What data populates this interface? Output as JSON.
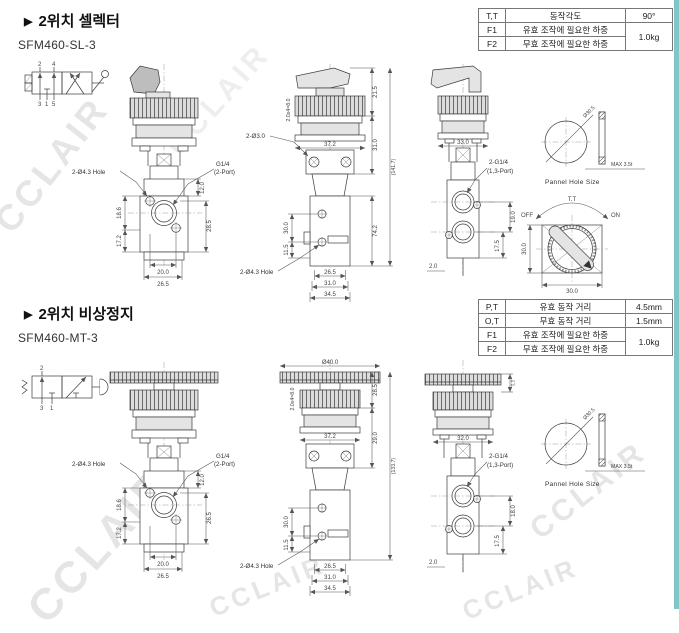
{
  "watermark": "CCLAIR",
  "selector": {
    "marker": "▶",
    "title": "2위치 셀렉터",
    "model": "SFM460-SL-3",
    "table": {
      "rows": [
        {
          "code": "T,T",
          "desc": "동작각도",
          "value": "90°"
        },
        {
          "code": "F1",
          "desc": "유효 조작에 필요한 하중",
          "value": "1.0kg"
        },
        {
          "code": "F2",
          "desc": "무효 조작에 필요한 하중",
          "value": ""
        }
      ]
    },
    "symbol": {
      "p2": "2",
      "p4": "4",
      "p3": "3",
      "p1": "1",
      "p5": "5"
    },
    "front": {
      "hole_label": "2-Ø4.3 Hole",
      "port_label_1": "G1/4",
      "port_label_2": "(2-Port)",
      "dim_top": "12.0",
      "dim_upper_left": "18.6",
      "dim_lower_left": "17.2",
      "dim_right": "28.5",
      "dim_bottom_inner": "20.0",
      "dim_bottom_outer": "26.5"
    },
    "side": {
      "rib_pitch": "2.0x4=8.0",
      "hole_label_top": "2-Ø3.0",
      "dim_knob": "21.5",
      "dim_collar_width": "37.2",
      "dim_mount": "31.0",
      "dim_body": "74.2",
      "dim_total": "(141.7)",
      "dim_hole_span": "30.0",
      "dim_hole_offset": "11.5",
      "hole_label_bottom": "2-Ø4.3 Hole",
      "dim_bottom_1": "26.5",
      "dim_bottom_2": "31.0",
      "dim_bottom_3": "34.5"
    },
    "right": {
      "dim_collar": "33.0",
      "port_label_1": "2-G1/4",
      "port_label_2": "(1,3-Port)",
      "dim_port_span": "19.0",
      "dim_port_bottom": "17.5",
      "dim_pin": "2.0"
    },
    "panel": {
      "dia": "Ø30.5",
      "max_thk": "MAX 3.5t",
      "caption": "Pannel Hole Size"
    },
    "knob_top": {
      "angle": "T.T",
      "off": "OFF",
      "on": "ON",
      "dim_w": "30.0",
      "dim_h": "30.0"
    }
  },
  "estop": {
    "marker": "▶",
    "title": "2위치 비상정지",
    "model": "SFM460-MT-3",
    "table": {
      "rows": [
        {
          "code": "P,T",
          "desc": "유효 동작 거리",
          "value": "4.5mm"
        },
        {
          "code": "O,T",
          "desc": "무효 동작 거리",
          "value": "1.5mm"
        },
        {
          "code": "F1",
          "desc": "유효 조작에 필요한 하중",
          "value": "1.0kg"
        },
        {
          "code": "F2",
          "desc": "무효 조작에 필요한 하중",
          "value": ""
        }
      ]
    },
    "symbol": {
      "p2": "2",
      "p3": "3",
      "p1": "1"
    },
    "front": {
      "hole_label": "2-Ø4.3 Hole",
      "port_label_1": "G1/4",
      "port_label_2": "(2-Port)",
      "dim_top": "12.0",
      "dim_upper_left": "18.6",
      "dim_lower_left": "17.2",
      "dim_right": "26.5",
      "dim_bottom_inner": "20.0",
      "dim_bottom_outer": "26.5"
    },
    "side": {
      "cap_dia": "Ø40.0",
      "rib_pitch": "2.0x4=8.0",
      "dim_cap": "28.5",
      "dim_collar_width": "37.2",
      "dim_mount": "29.0",
      "dim_total": "(133.7)",
      "dim_hole_span": "30.0",
      "dim_hole_offset": "11.5",
      "hole_label_bottom": "2-Ø4.3 Hole",
      "dim_bottom_1": "26.5",
      "dim_bottom_2": "31.0",
      "dim_bottom_3": "34.5"
    },
    "right": {
      "dim_travel": "T.T",
      "dim_collar": "32.0",
      "port_label_1": "2-G1/4",
      "port_label_2": "(1,3-Port)",
      "dim_port_span": "18.0",
      "dim_port_bottom": "17.5",
      "dim_pin": "2.0"
    },
    "panel": {
      "dia": "Ø30.5",
      "max_thk": "MAX 3.5t",
      "caption": "Pannel Hole Size"
    }
  }
}
